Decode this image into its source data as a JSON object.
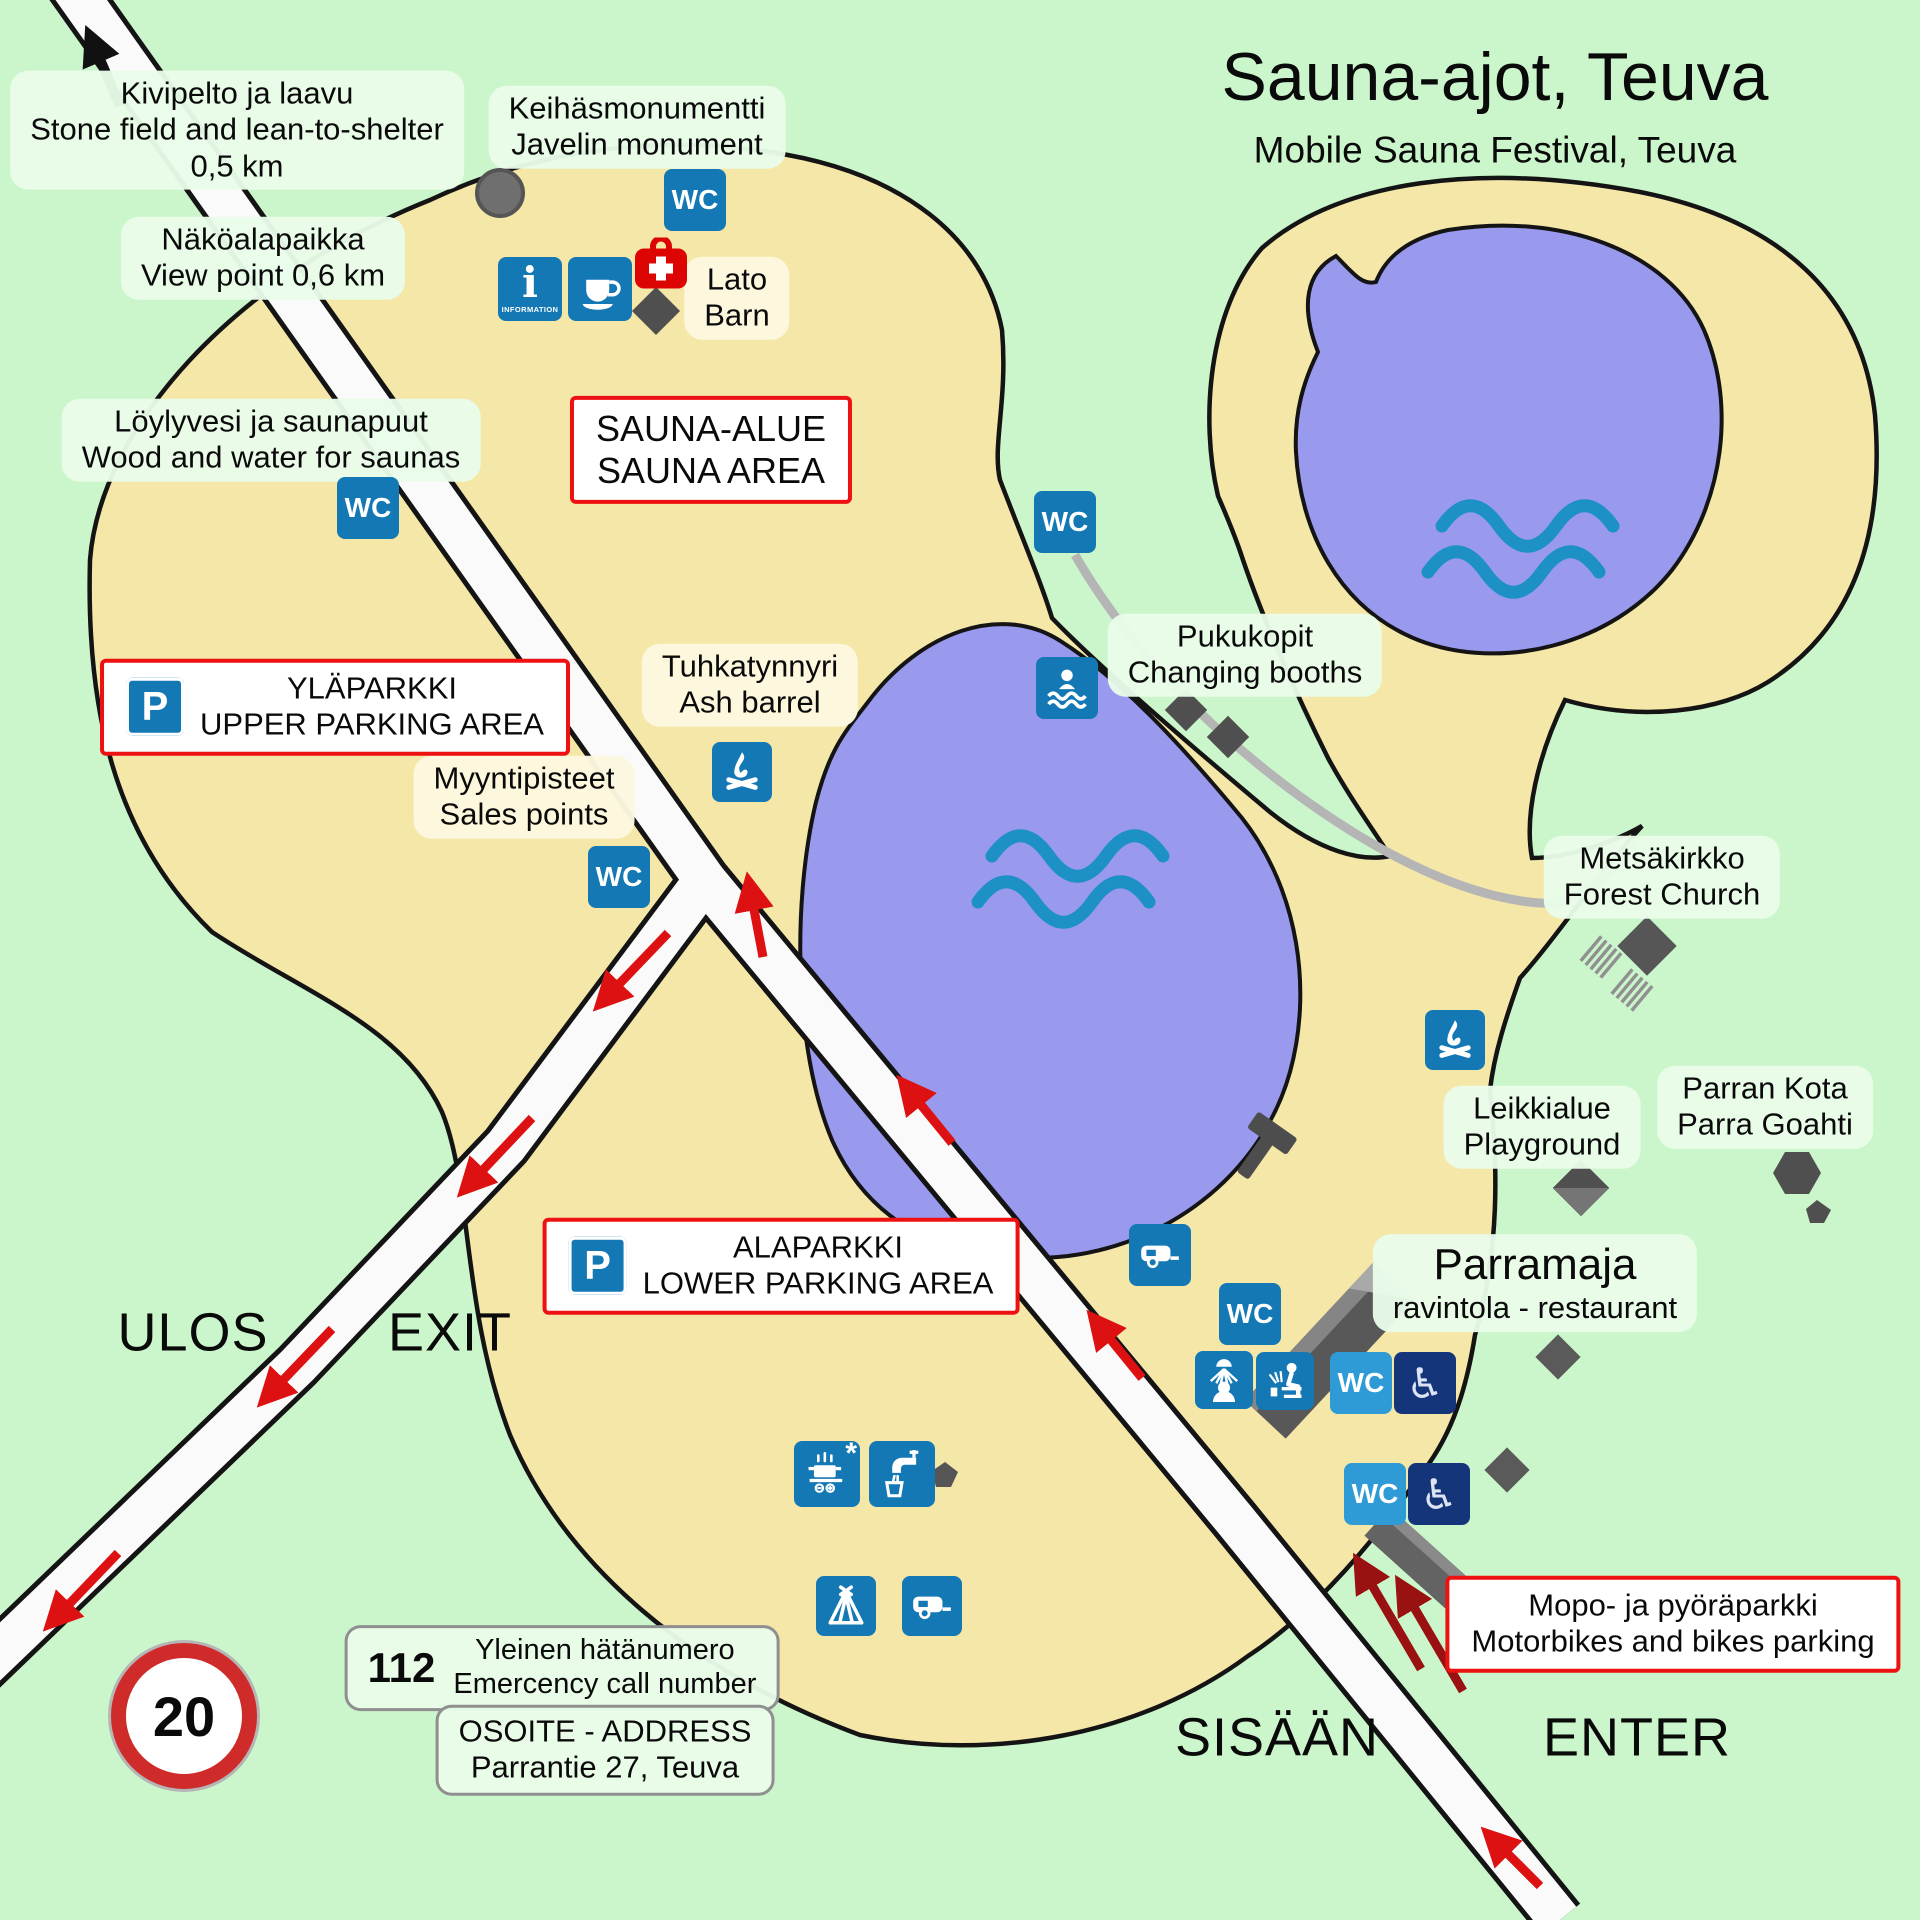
{
  "title": {
    "main": "Sauna-ajot, Teuva",
    "sub": "Mobile Sauna Festival, Teuva"
  },
  "labels": {
    "kivipelto": {
      "fi": "Kivipelto ja laavu",
      "en": "Stone field and lean-to-shelter",
      "dist": "0,5 km"
    },
    "nakoalapaikka": {
      "fi": "Näköalapaikka",
      "en": "View point 0,6 km"
    },
    "keihasmonumentti": {
      "fi": "Keihäsmonumentti",
      "en": "Javelin monument"
    },
    "loylyvesi": {
      "fi": "Löylyvesi ja saunapuut",
      "en": "Wood and water for saunas"
    },
    "lato": {
      "fi": "Lato",
      "en": "Barn"
    },
    "tuhkatynnyri": {
      "fi": "Tuhkatynnyri",
      "en": "Ash barrel"
    },
    "myyntipisteet": {
      "fi": "Myyntipisteet",
      "en": "Sales points"
    },
    "pukukopit": {
      "fi": "Pukukopit",
      "en": "Changing booths"
    },
    "metsakirkko": {
      "fi": "Metsäkirkko",
      "en": "Forest Church"
    },
    "parran_kota": {
      "fi": "Parran Kota",
      "en": "Parra Goahti"
    },
    "leikkialue": {
      "fi": "Leikkialue",
      "en": "Playground"
    },
    "parramaja": {
      "fi": "Parramaja",
      "en": "ravintola - restaurant"
    }
  },
  "areas": {
    "sauna_alue": {
      "fi": "SAUNA-ALUE",
      "en": "SAUNA AREA"
    }
  },
  "parking": {
    "upper": {
      "fi": "YLÄPARKKI",
      "en": "UPPER PARKING AREA"
    },
    "lower": {
      "fi": "ALAPARKKI",
      "en": "LOWER PARKING AREA"
    },
    "moped": {
      "fi": "Mopo- ja pyöräparkki",
      "en": "Motorbikes and bikes parking"
    }
  },
  "directions": {
    "ulos": "ULOS",
    "exit": "EXIT",
    "sisaan": "SISÄÄN",
    "enter": "ENTER"
  },
  "signs": {
    "speed_limit": "20",
    "emergency": {
      "number": "112",
      "fi": "Yleinen hätänumero",
      "en": "Emercency call number"
    },
    "address": {
      "title": "OSOITE - ADDRESS",
      "street": "Parrantie 27, Teuva"
    }
  },
  "icons": {
    "wc": "WC",
    "parking": "P",
    "info_glyph": "i",
    "information_label": "INFORMATION",
    "cooking_note": "*"
  },
  "colors": {
    "background": "#cbf6cb",
    "land": "#f5e7a8",
    "lake": "#9999ee",
    "wave": "#1d91c5",
    "icon_blue": "#1478b5",
    "icon_blue_light": "#2f9bd6",
    "icon_navy": "#15357a",
    "first_aid_red": "#dd0404",
    "box_border_red": "#ee1111",
    "arrow_red": "#dd1111",
    "arrow_dark_red": "#991111",
    "speed_ring_red": "#cf2b2b",
    "road": "#fafafa"
  }
}
